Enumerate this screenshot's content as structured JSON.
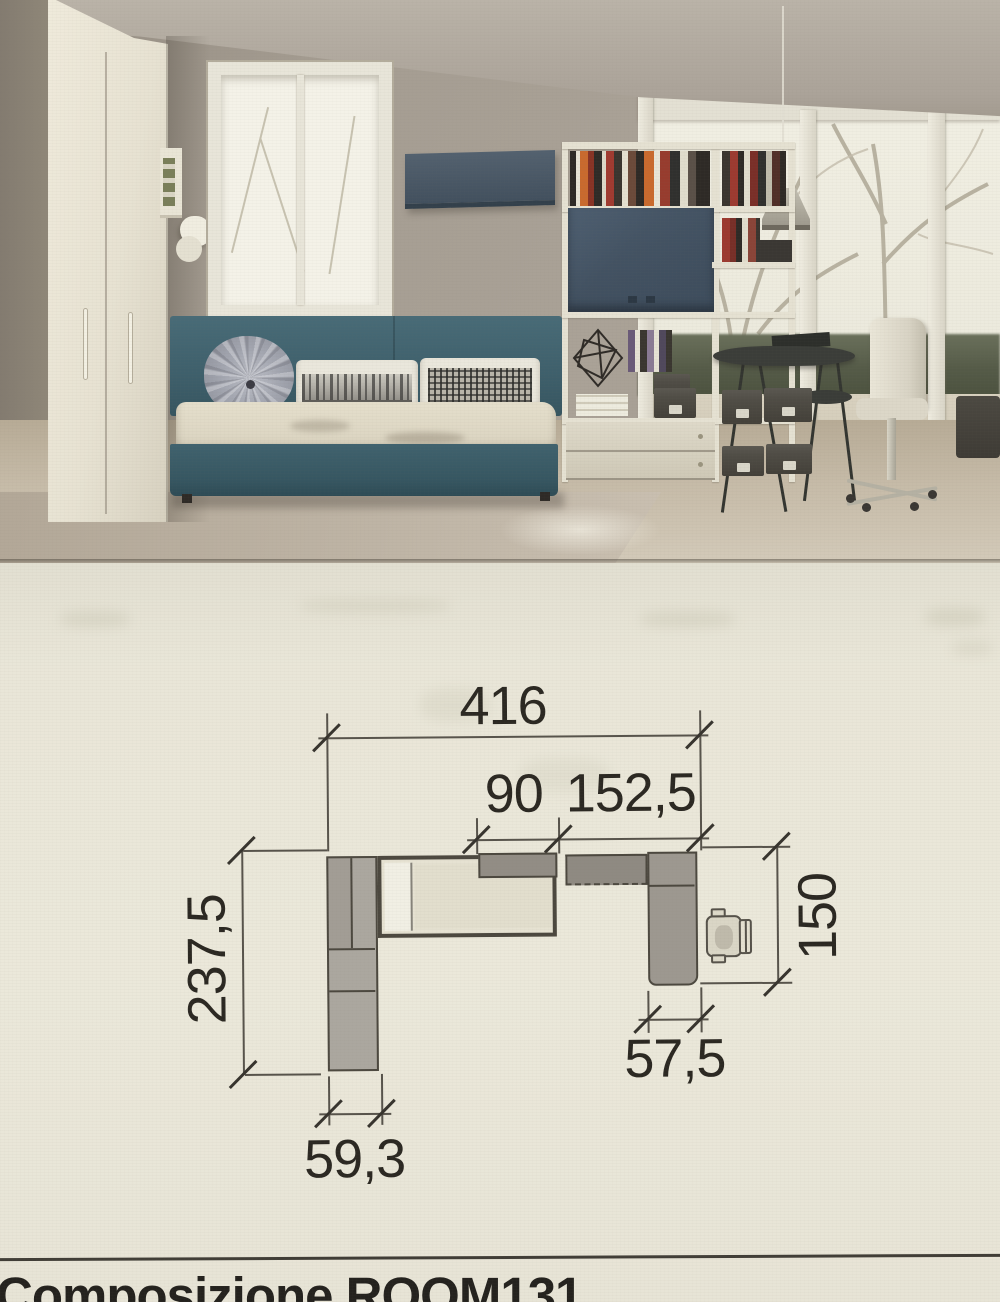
{
  "plan": {
    "dim_total_width": "416",
    "dim_shelf_width": "90",
    "dim_desk_top_width": "152,5",
    "dim_left_depth": "237,5",
    "dim_right_depth": "150",
    "dim_desk_depth": "57,5",
    "dim_wardrobe_depth": "59,3"
  },
  "footer": {
    "caption": "Composizione ROOM131"
  },
  "colors": {
    "paper": "#eae7d9",
    "bed_teal": "#3e5f6b",
    "cabinet_denim": "#44536a",
    "plan_gray": "#9d9890",
    "ink": "#2b2822"
  }
}
